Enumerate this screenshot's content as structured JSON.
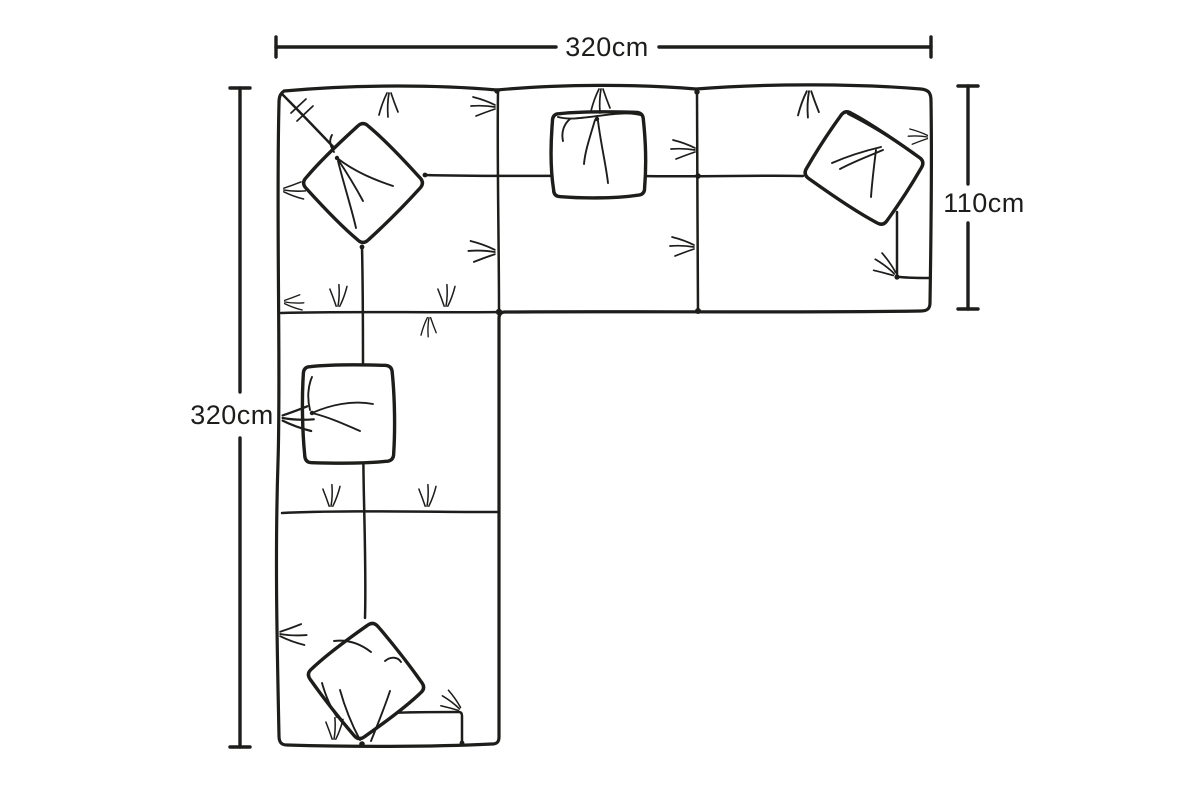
{
  "dimension_labels": {
    "top_width": "320cm",
    "left_height": "320cm",
    "right_depth": "110cm"
  },
  "colors": {
    "ink": "#1d1d1b",
    "background": "#ffffff"
  }
}
